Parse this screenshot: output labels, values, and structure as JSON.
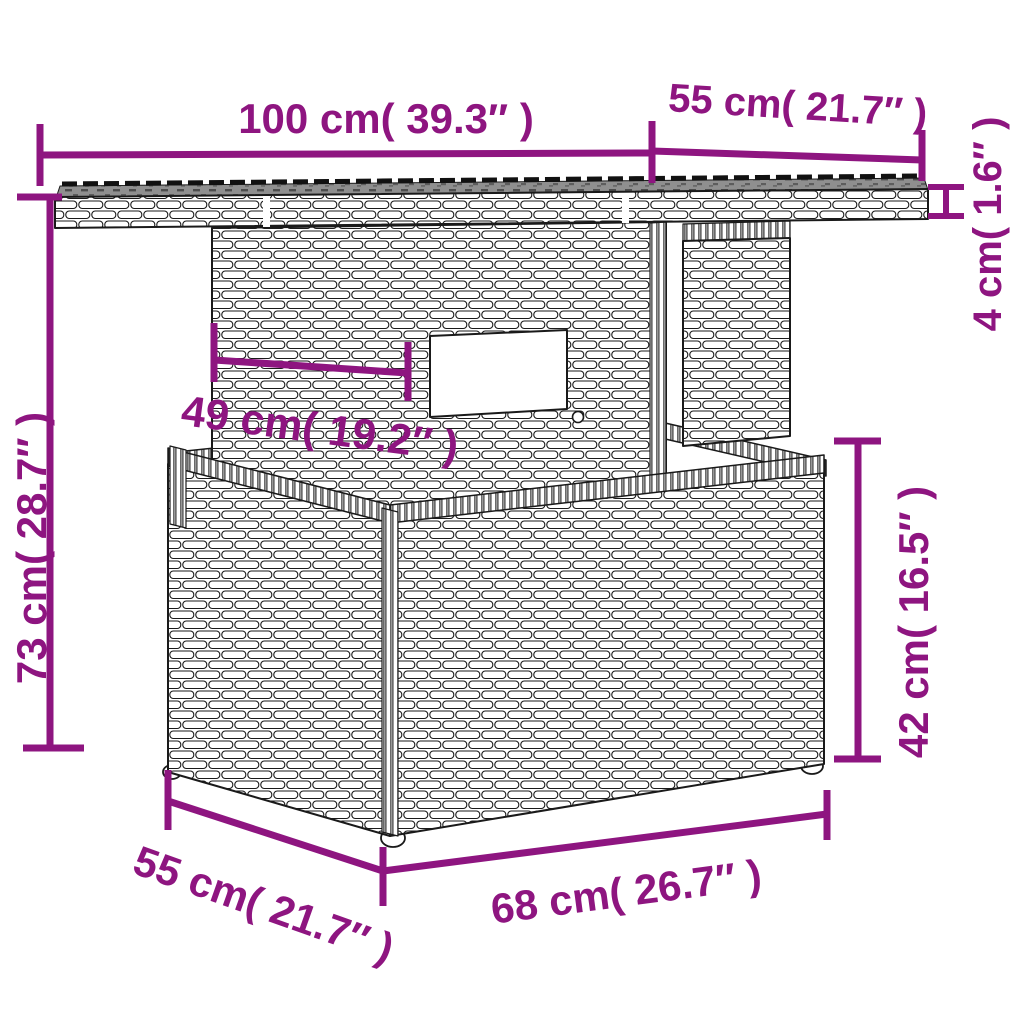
{
  "figure": {
    "title": "Rattan garden table dimension diagram",
    "style": "black line-art wicker drawing with magenta dimension annotations",
    "colors": {
      "accent": "#8e1580",
      "line_art": "#1a1a1a",
      "glass_top": "#8f8f8f",
      "background": "#ffffff"
    }
  },
  "dimensions": {
    "tabletop_width": {
      "label": "100 cm( 39.3″ )",
      "cm": 100,
      "inches": 39.3
    },
    "tabletop_depth": {
      "label": "55 cm( 21.7″ )",
      "cm": 55,
      "inches": 21.7
    },
    "tabletop_thickness": {
      "label": "4 cm( 1.6″ )",
      "cm": 4,
      "inches": 1.6
    },
    "total_height": {
      "label": "73 cm( 28.7″ )",
      "cm": 73,
      "inches": 28.7
    },
    "pedestal_width": {
      "label": "49 cm( 19.2″ )",
      "cm": 49,
      "inches": 19.2
    },
    "base_height": {
      "label": "42 cm( 16.5″ )",
      "cm": 42,
      "inches": 16.5
    },
    "base_depth": {
      "label": "55 cm( 21.7″ )",
      "cm": 55,
      "inches": 21.7
    },
    "base_width": {
      "label": "68 cm( 26.7″ )",
      "cm": 68,
      "inches": 26.7
    }
  }
}
